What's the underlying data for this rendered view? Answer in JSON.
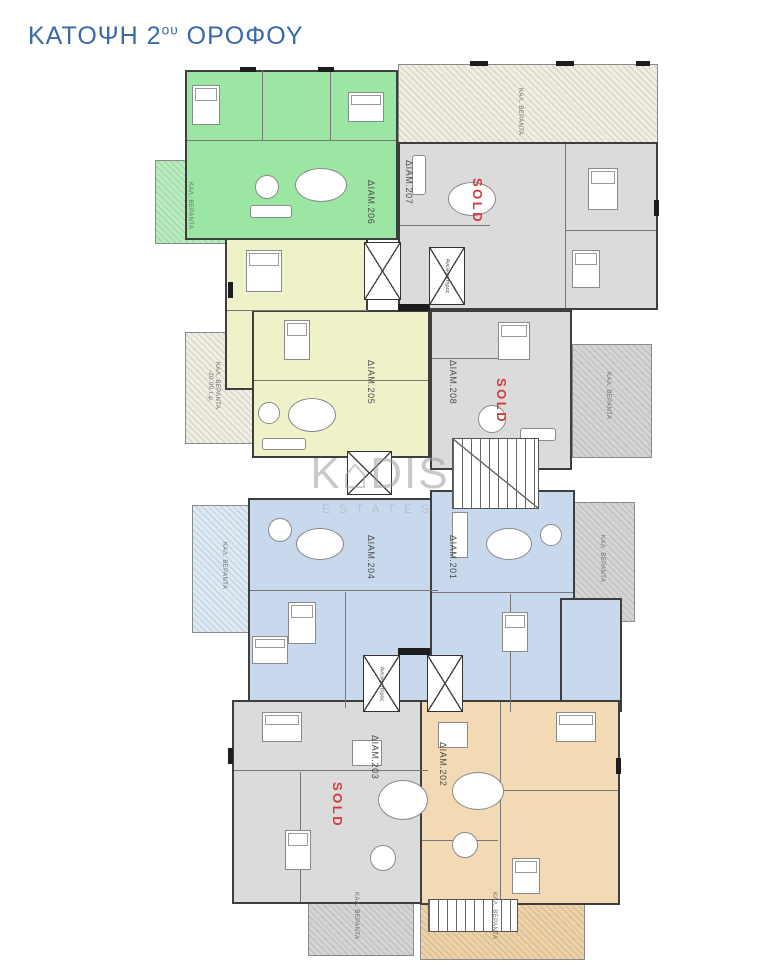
{
  "page": {
    "title": {
      "prefix": "ΚΑΤΟΨΗ 2",
      "sup": "ου",
      "suffix": " ΟΡΟΦΟΥ"
    }
  },
  "watermark": {
    "brand": "K⌂DIS",
    "subtitle": "ESTATES"
  },
  "labels": {
    "sold": "SOLD",
    "elevator": "Ανελκυστήρας",
    "veranda": "ΚΑΛ. ΒΕΡΑΝΤΑ",
    "veranda_area": "-20.00 τ.μ."
  },
  "colors": {
    "title": "#3a6aa6",
    "sold": "#d43a3a",
    "green": "#9ce6a3",
    "gray": "#dbdbdb",
    "yellow": "#eff1c9",
    "blue": "#c8d9ee",
    "orange": "#f3d9b4"
  },
  "apartments": {
    "a206": {
      "label": "ΔΙΑΜ.206",
      "sold": false
    },
    "a207": {
      "label": "ΔΙΑΜ.207",
      "sold": true
    },
    "a205": {
      "label": "ΔΙΑΜ.205",
      "sold": false
    },
    "a208": {
      "label": "ΔΙΑΜ.208",
      "sold": true
    },
    "a204": {
      "label": "ΔΙΑΜ.204",
      "sold": false
    },
    "a201": {
      "label": "ΔΙΑΜ.201",
      "sold": false
    },
    "a203": {
      "label": "ΔΙΑΜ.203",
      "sold": true
    },
    "a202": {
      "label": "ΔΙΑΜ.202",
      "sold": false
    }
  }
}
